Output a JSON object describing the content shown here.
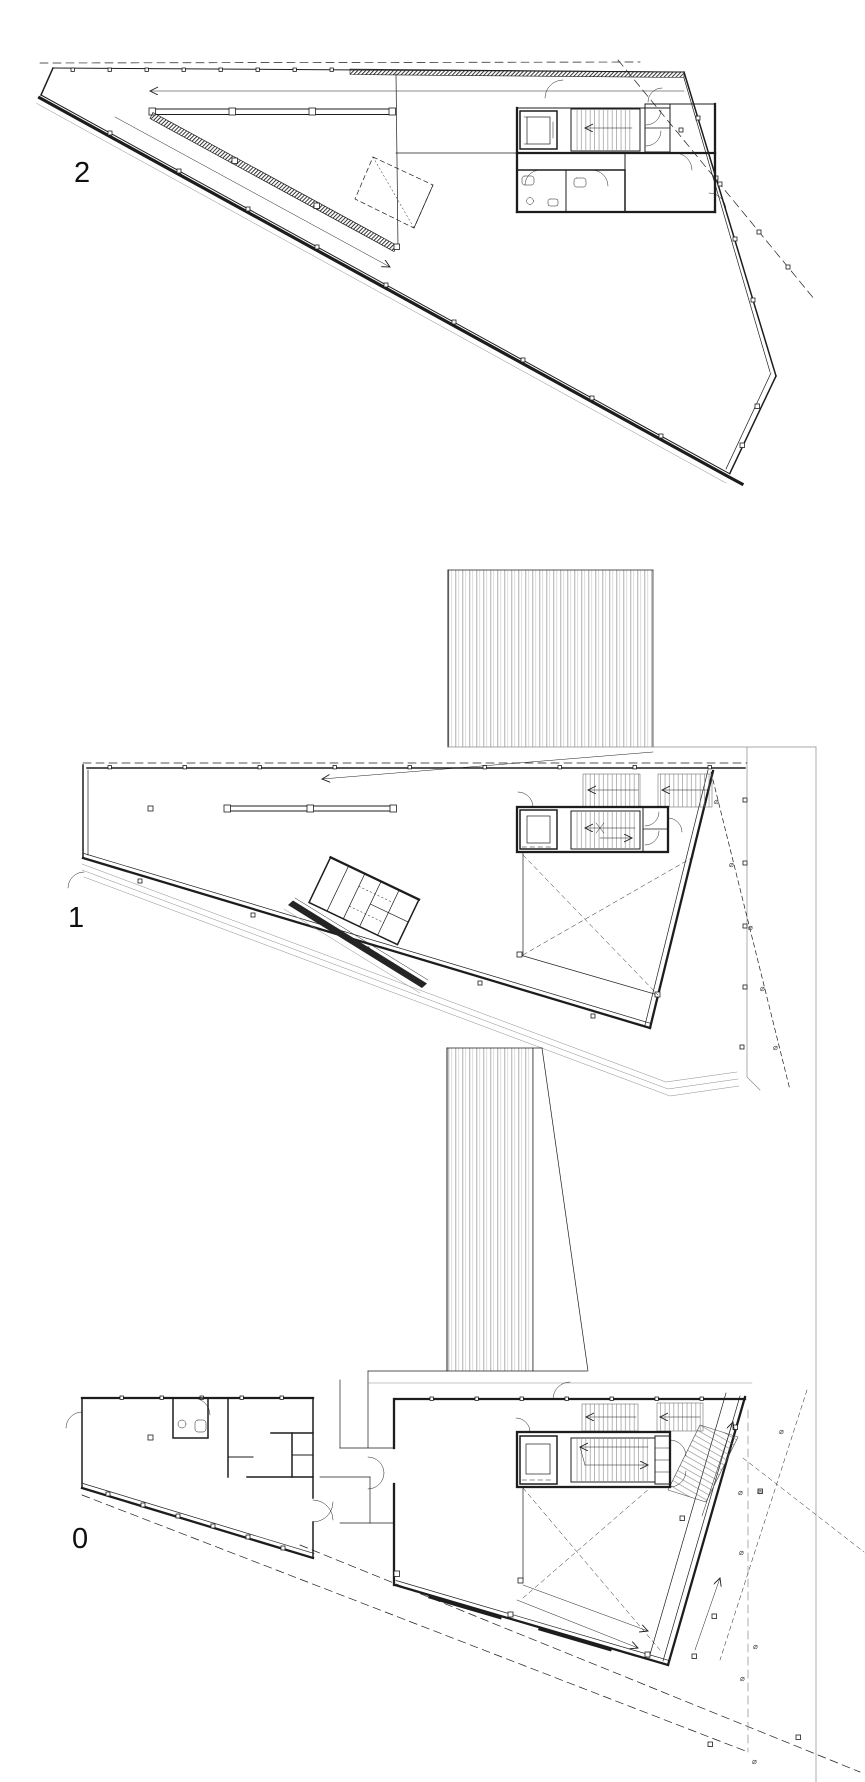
{
  "drawing": {
    "title": "floor-plans-sheet",
    "background": "#ffffff",
    "line_color": "#1d1d1d",
    "muted_line_color": "#8b8b8b",
    "tree_symbol": "⌀",
    "plans": [
      {
        "id": "floor-2",
        "label": "2",
        "name": "second-floor-plan"
      },
      {
        "id": "floor-1",
        "label": "1",
        "name": "first-floor-plan"
      },
      {
        "id": "floor-0",
        "label": "0",
        "name": "ground-floor-plan"
      }
    ]
  }
}
